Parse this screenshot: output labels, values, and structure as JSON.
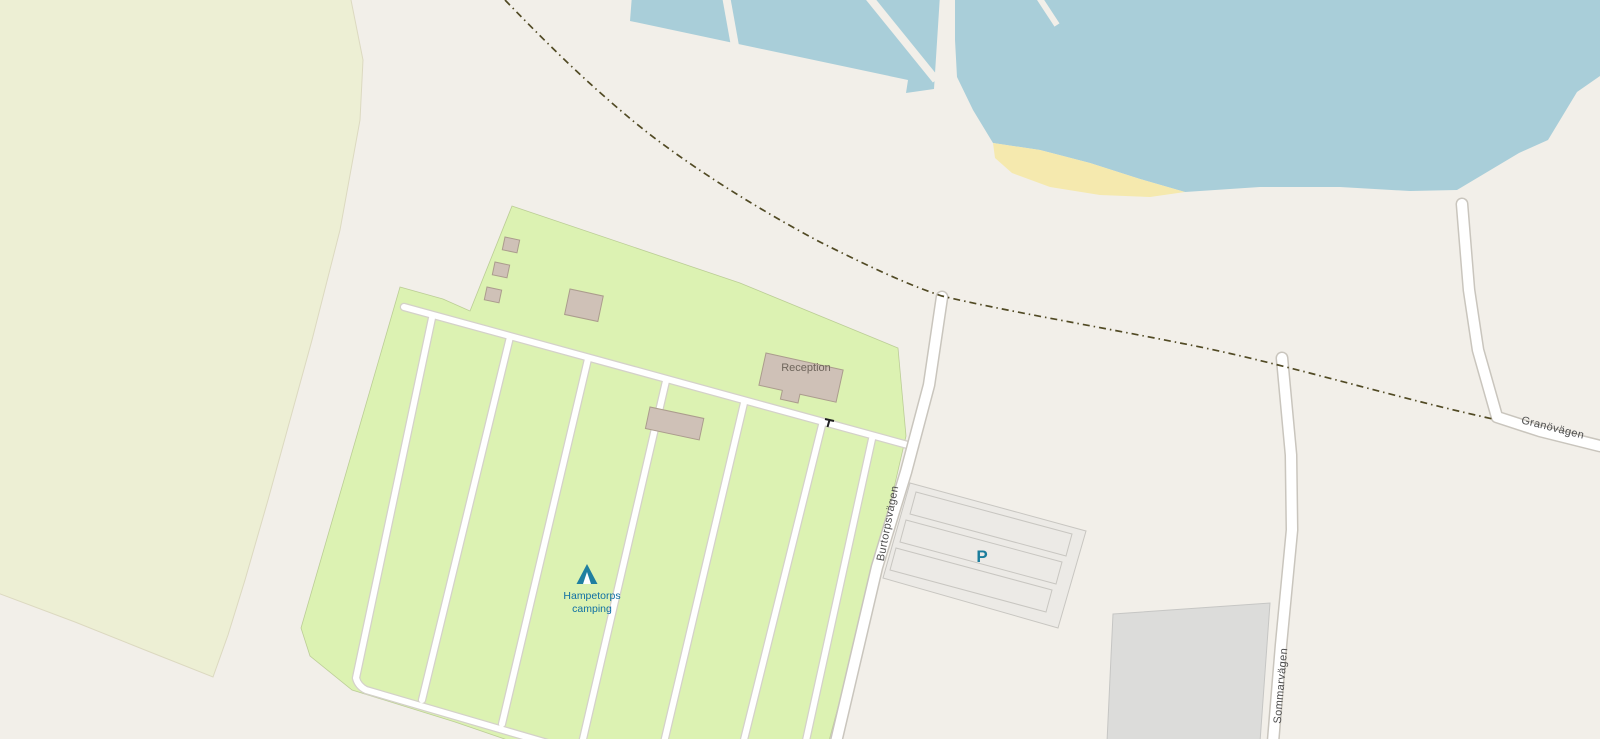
{
  "map": {
    "labels": {
      "reception": "Reception",
      "campsite_line1": "Hampetorps",
      "campsite_line2": "camping",
      "road_burtorpsvagen": "Burtorpsvägen",
      "road_granovagen": "Granövägen",
      "road_sommarvagen": "Sommarvägen",
      "parking_symbol": "P"
    },
    "colors": {
      "land": "#f2efe9",
      "farmland": "#edefd4",
      "campground": "#dcf2b2",
      "campground_outline": "#a9bd80",
      "water": "#a9ced9",
      "beach": "#f5e9ae",
      "building": "#cfc1b7",
      "building_outline": "#ab9c8d",
      "road_fill": "#ffffff",
      "road_casing": "#c9c5bd",
      "internal_road_casing": "#d4d1c9",
      "parking_surface": "#eceae6",
      "parking_row_outline": "#c8c6c1",
      "paved_area": "#dcdcda",
      "track_dash": "#514a24",
      "poi_label": "#0f6fa3",
      "parking_icon": "#1b7d9c",
      "road_label": "#4e4e4e",
      "building_label": "#6e655b"
    },
    "icons": [
      "tent-icon",
      "gate-icon",
      "parking-p-icon"
    ]
  }
}
